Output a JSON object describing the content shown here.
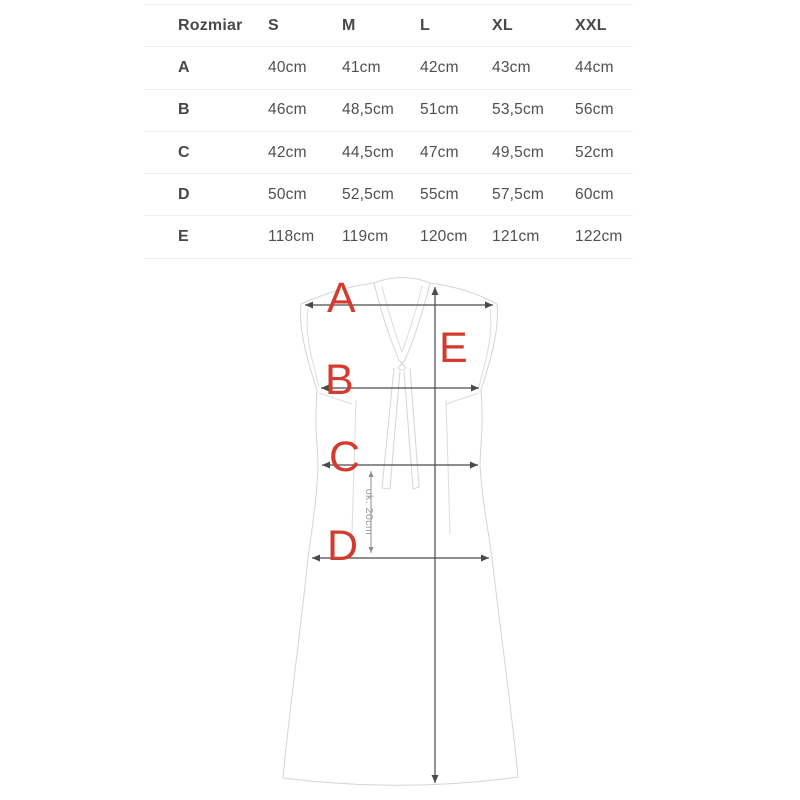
{
  "size_table": {
    "columns": [
      "Rozmiar",
      "S",
      "M",
      "L",
      "XL",
      "XXL"
    ],
    "rows": [
      {
        "label": "A",
        "values": [
          "40cm",
          "41cm",
          "42cm",
          "43cm",
          "44cm"
        ]
      },
      {
        "label": "B",
        "values": [
          "46cm",
          "48,5cm",
          "51cm",
          "53,5cm",
          "56cm"
        ]
      },
      {
        "label": "C",
        "values": [
          "42cm",
          "44,5cm",
          "47cm",
          "49,5cm",
          "52cm"
        ]
      },
      {
        "label": "D",
        "values": [
          "50cm",
          "52,5cm",
          "55cm",
          "57,5cm",
          "60cm"
        ]
      },
      {
        "label": "E",
        "values": [
          "118cm",
          "119cm",
          "120cm",
          "121cm",
          "122cm"
        ]
      }
    ]
  },
  "diagram": {
    "labels": {
      "a": "A",
      "b": "B",
      "c": "C",
      "d": "D",
      "e": "E"
    },
    "approx_note": "ok. 20cm",
    "label_color": "#d43a2e",
    "sketch_color": "#d4d4d4",
    "measure_color": "#4a4a4a"
  }
}
